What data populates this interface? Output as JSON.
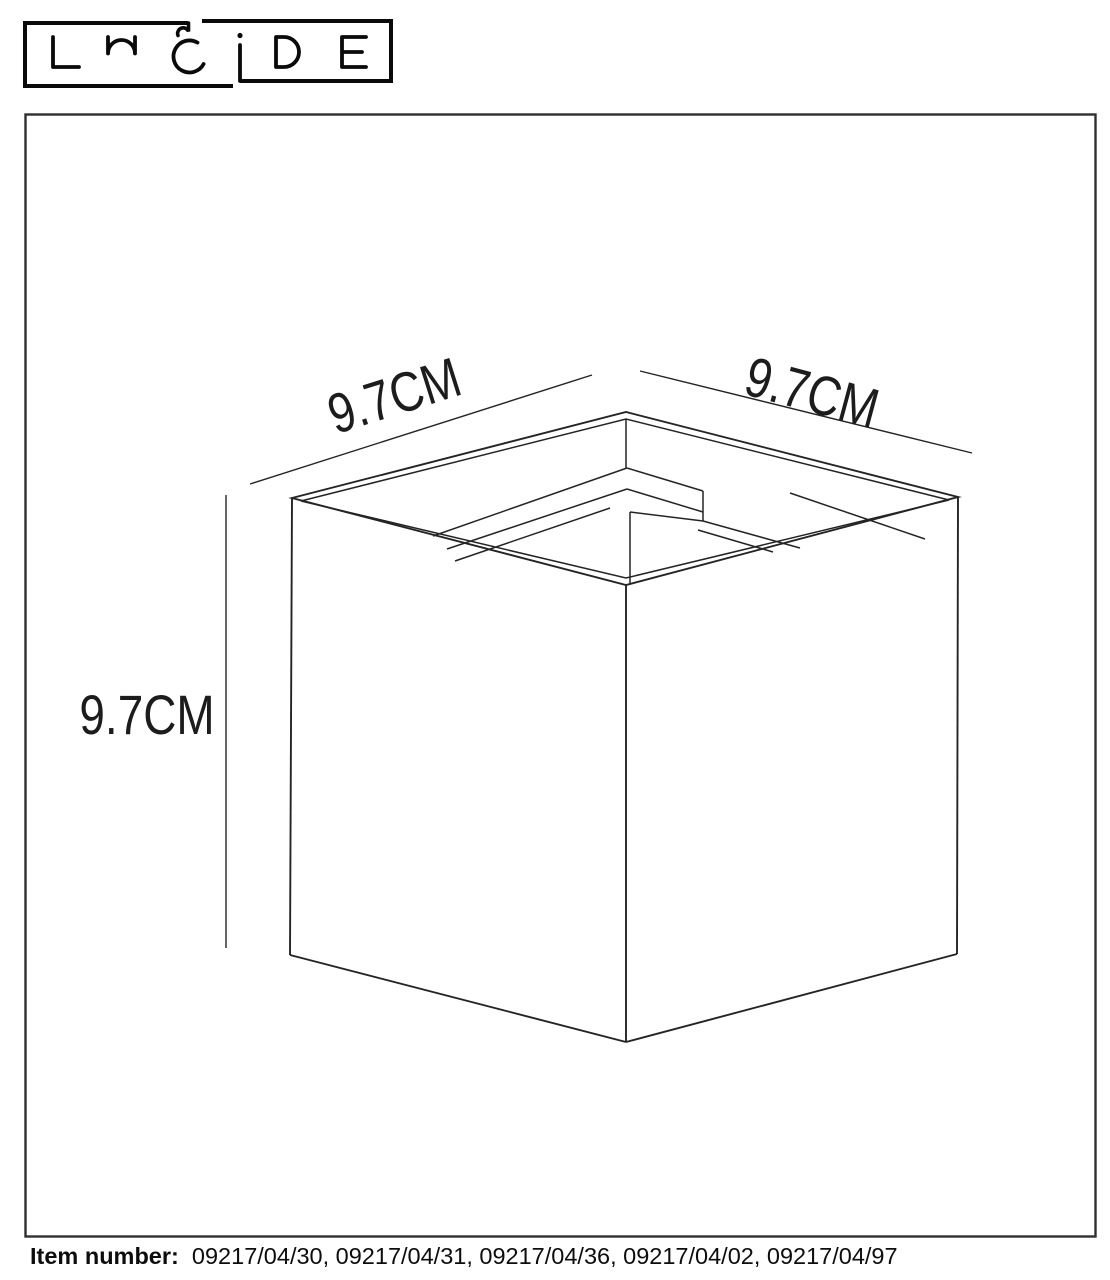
{
  "logo": {
    "brand": "LUCIDE"
  },
  "diagram": {
    "dim_top_left": "9.7CM",
    "dim_top_right": "9.7CM",
    "dim_height": "9.7CM"
  },
  "footer": {
    "label": "Item number:",
    "numbers": "09217/04/30, 09217/04/31, 09217/04/36, 09217/04/02, 09217/04/97"
  },
  "colors": {
    "line": "#242424",
    "border": "#2f2f2f",
    "logo": "#0a0a0a",
    "background": "#ffffff"
  }
}
